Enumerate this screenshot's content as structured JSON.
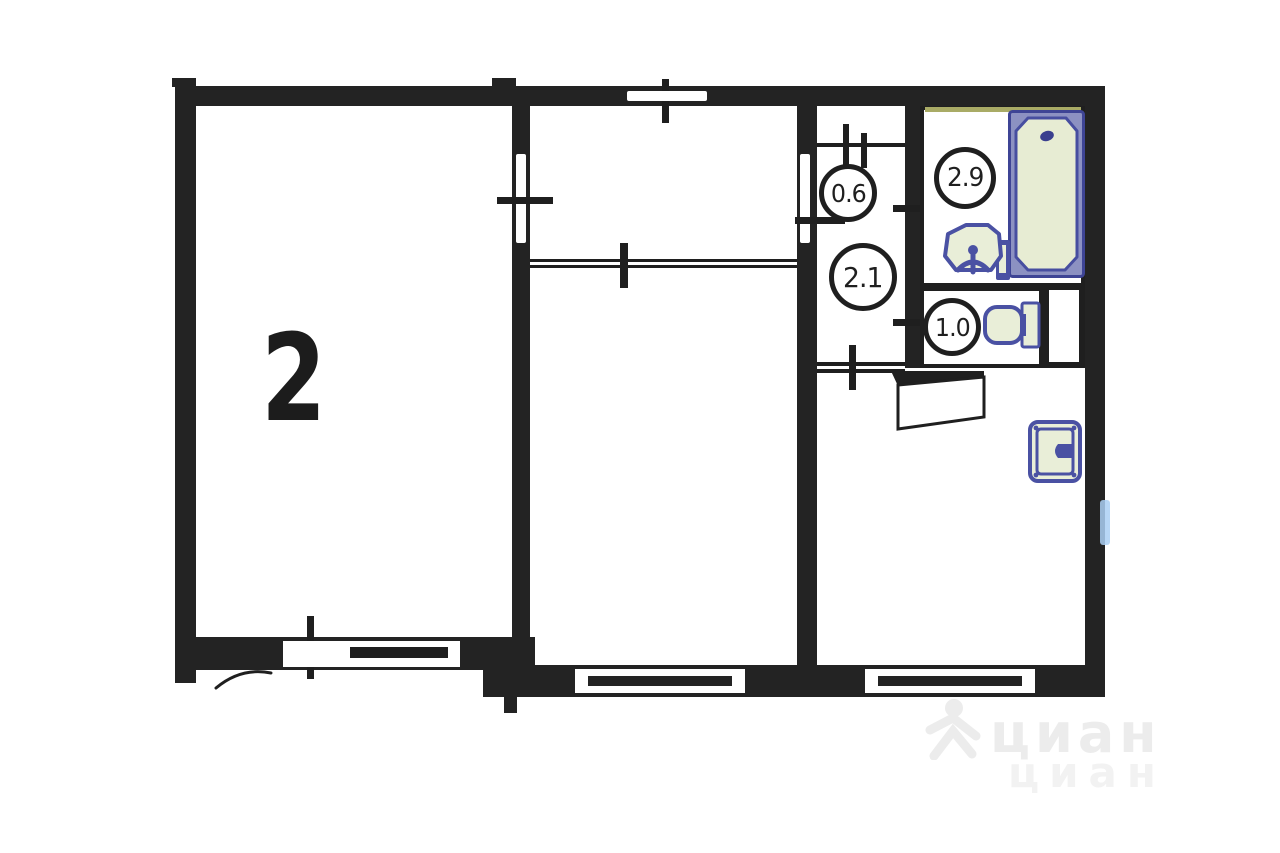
{
  "plan": {
    "main_room_label": "2",
    "closet_area": "0.6",
    "hallway_area": "2.1",
    "bathroom_area": "2.9",
    "wc_area": "1.0"
  },
  "watermark": {
    "brand_primary": "циан",
    "brand_secondary": "циан"
  },
  "icons": [
    "bathtub-icon",
    "bath-sink-icon",
    "toilet-icon",
    "kitchen-sink-icon",
    "door-leaf-icon",
    "door-swing-arc-icon",
    "window-icon",
    "radiator-icon",
    "watermark-figure-icon"
  ],
  "colors": {
    "wall": "#232323",
    "fixture_stroke": "#4a51a3",
    "fixture_fill": "#e9eed8",
    "tub_field": "#8c91c2",
    "tub_basin": "#e7ecd3",
    "olive_accent": "#a9ab66",
    "radiator_blue": "#abd0f5",
    "watermark_gray": "#ececec"
  }
}
